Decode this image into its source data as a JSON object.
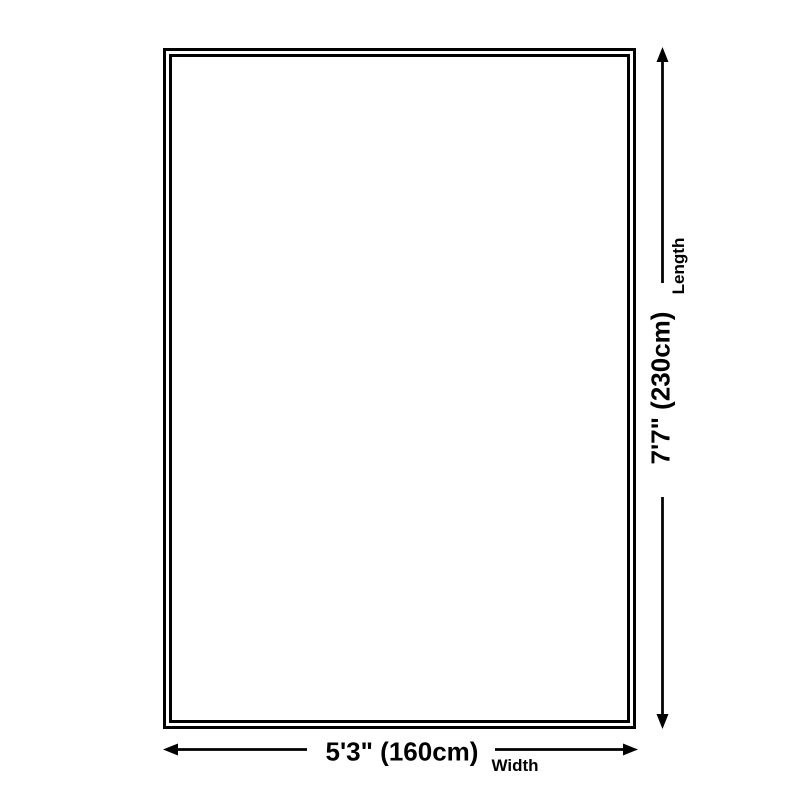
{
  "colors": {
    "background": "#ffffff",
    "line": "#000000",
    "text": "#000000"
  },
  "icons": {
    "length_arrow": "double-headed-vertical-arrow",
    "width_arrow": "double-headed-horizontal-arrow"
  },
  "dimensions": {
    "length": {
      "label": "Length",
      "value": "7'7\" (230cm)"
    },
    "width": {
      "label": "Width",
      "value": "5'3\" (160cm)"
    }
  }
}
